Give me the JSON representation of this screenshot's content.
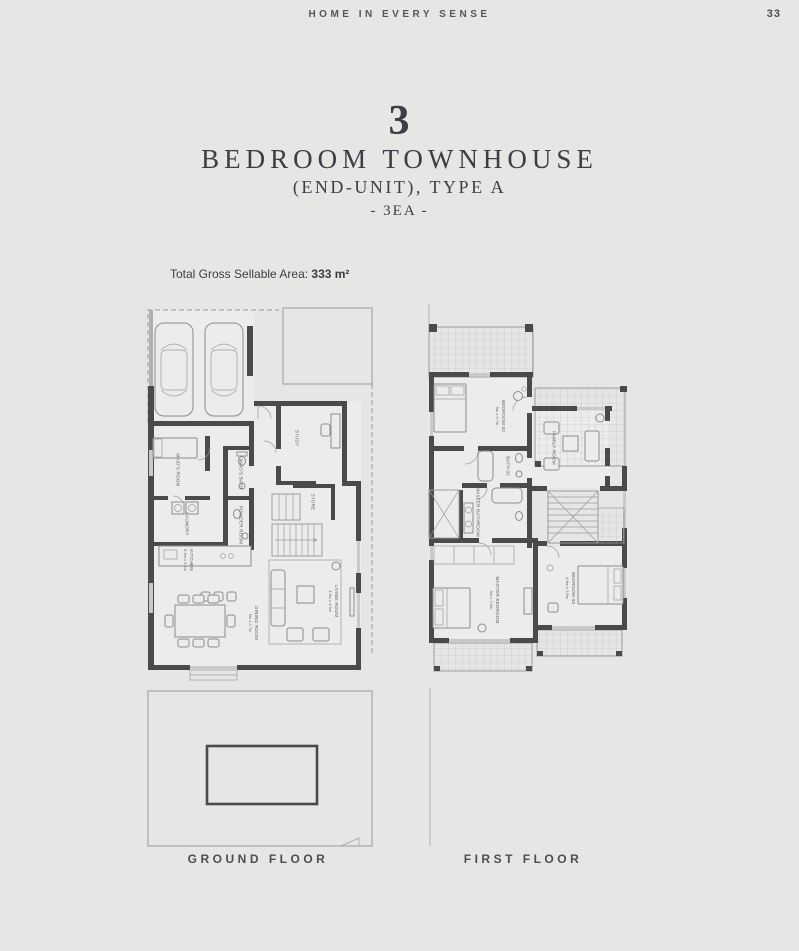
{
  "page": {
    "header": "HOME IN EVERY SENSE",
    "page_number": "33",
    "title_number": "3",
    "title_line1": "BEDROOM TOWNHOUSE",
    "title_line2": "(END-UNIT), TYPE A",
    "title_line3": "- 3EA -",
    "area_label": "Total Gross Sellable Area: ",
    "area_value": "333 m²"
  },
  "colors": {
    "background": "#e6e6e4",
    "ink": "#3b3e44",
    "walls": "#4a4a4a",
    "thin_lines": "#9b9b99",
    "floor_fill": "#edecea"
  },
  "floors": {
    "ground": {
      "caption": "GROUND FLOOR",
      "rooms": {
        "study": {
          "label": "STUDY"
        },
        "maids_room": {
          "label": "MAID'S ROOM"
        },
        "maids_bath": {
          "label": "MAID'S BATH"
        },
        "laundry": {
          "label": "LAUNDRY"
        },
        "powder_room": {
          "label": "POWDER ROOM"
        },
        "store": {
          "label": "STORE"
        },
        "kitchen": {
          "label": "KITCHEN",
          "dim": "5.3m x 3.1m"
        },
        "dining_room": {
          "label": "DINING ROOM",
          "dim": "5m x 3.7m"
        },
        "living_room": {
          "label": "LIVING ROOM",
          "dim": "4.9m x 4.9m"
        }
      }
    },
    "first": {
      "caption": "FIRST FLOOR",
      "rooms": {
        "bedroom02": {
          "label": "BEDROOM 02",
          "dim": "5m x 3.7m"
        },
        "family_room": {
          "label": "FAMILY ROOM"
        },
        "bath02": {
          "label": "BATH 02"
        },
        "master_bathroom": {
          "label": "MASTER BATHROOM"
        },
        "master_bedroom": {
          "label": "MASTER BEDROOM",
          "dim": "5m x 3.9m"
        },
        "bedroom03": {
          "label": "BEDROOM 03",
          "dim": "4.8m x 3.5m"
        }
      }
    }
  }
}
